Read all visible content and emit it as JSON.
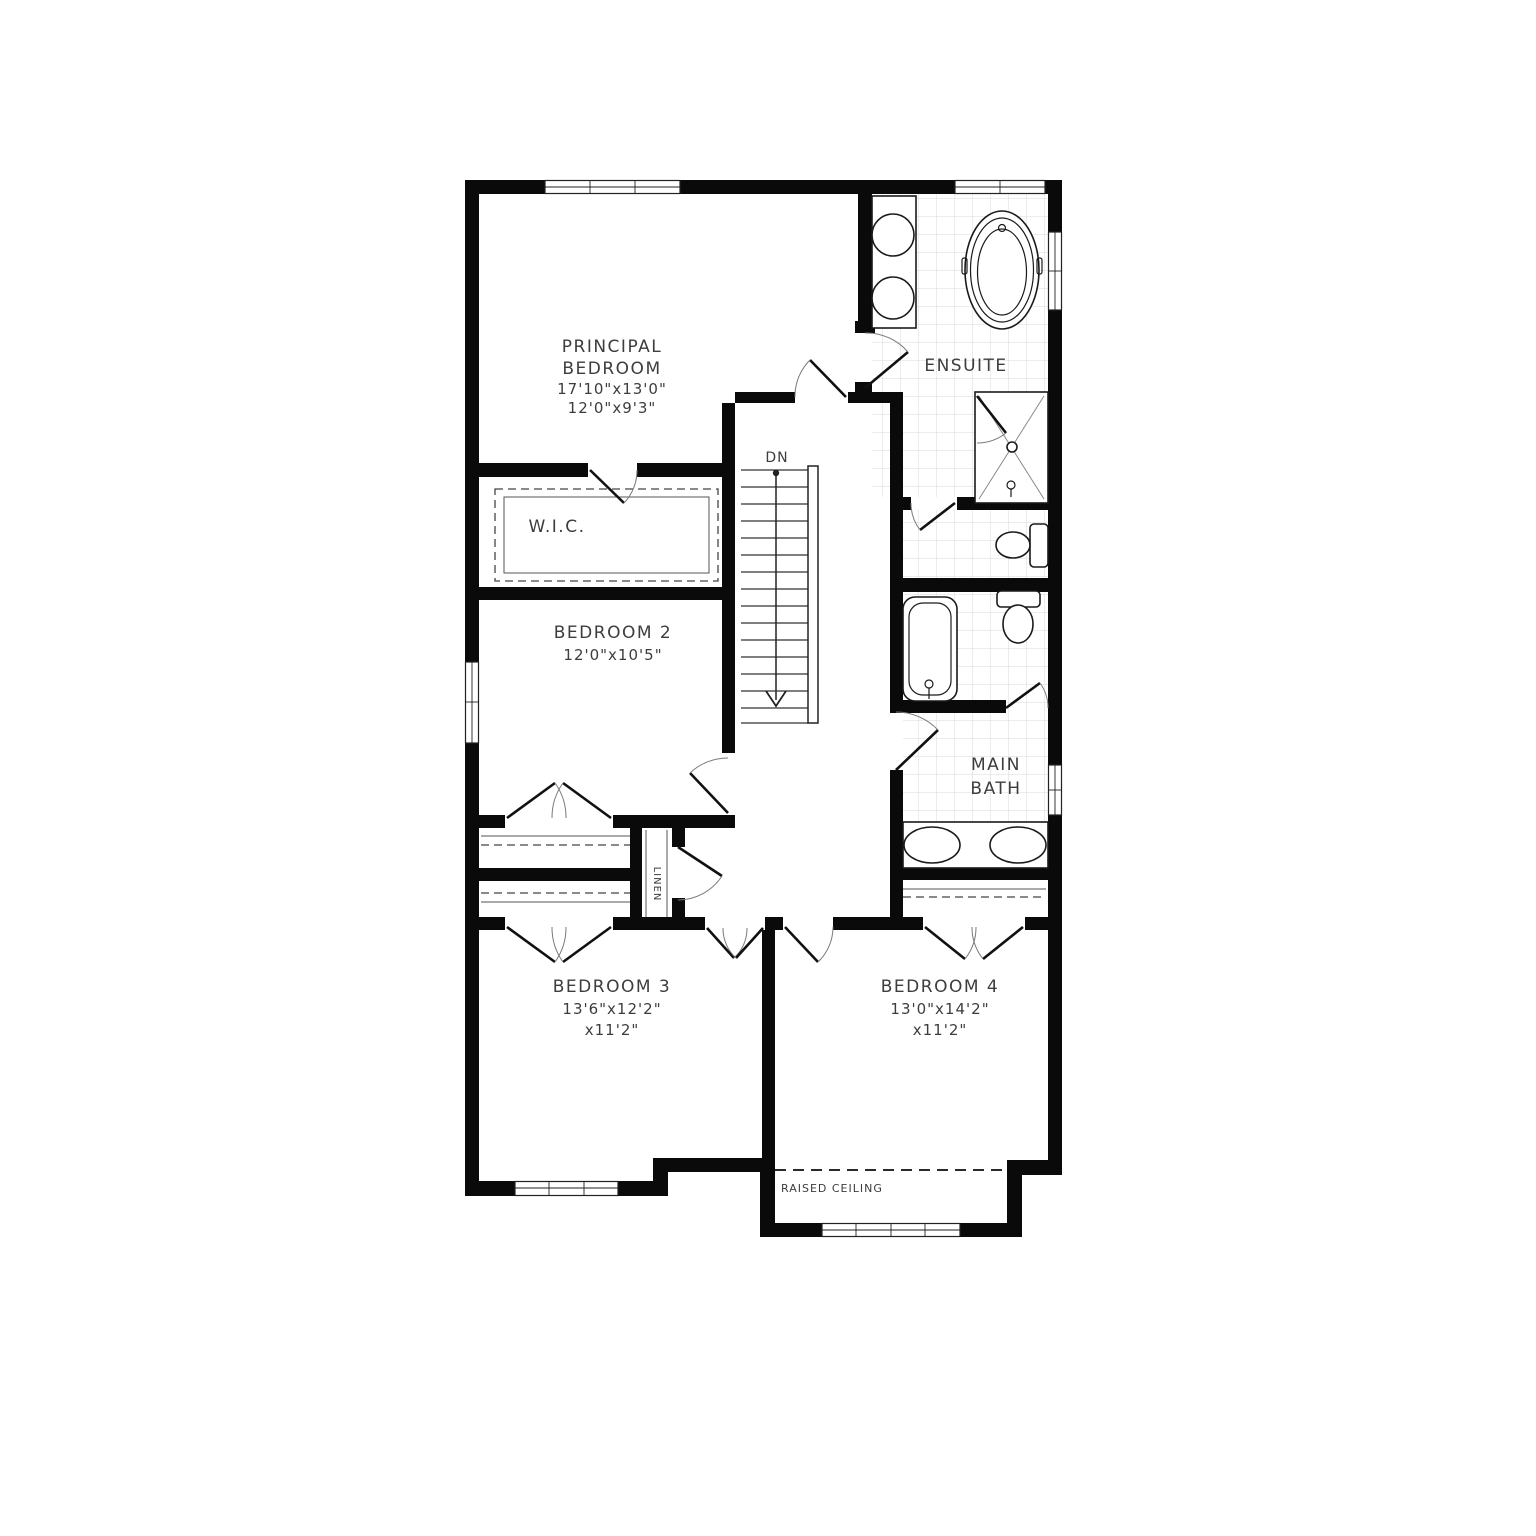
{
  "plan": {
    "rooms": {
      "principal_bedroom": {
        "name_line1": "PRINCIPAL",
        "name_line2": "BEDROOM",
        "dim_line1": "17'10\"x13'0\"",
        "dim_line2": "12'0\"x9'3\""
      },
      "ensuite": {
        "name": "ENSUITE"
      },
      "wic": {
        "name": "W.I.C."
      },
      "bedroom2": {
        "name": "BEDROOM 2",
        "dim_line1": "12'0\"x10'5\""
      },
      "main_bath": {
        "name_line1": "MAIN",
        "name_line2": "BATH"
      },
      "bedroom3": {
        "name": "BEDROOM 3",
        "dim_line1": "13'6\"x12'2\"",
        "dim_line2": "x11'2\""
      },
      "bedroom4": {
        "name": "BEDROOM 4",
        "dim_line1": "13'0\"x14'2\"",
        "dim_line2": "x11'2\""
      },
      "linen_closet": {
        "name": "LINEN"
      }
    },
    "annotations": {
      "stair_direction": "DN",
      "raised_ceiling": "RAISED CEILING"
    },
    "colors": {
      "wall": "#0a0a0a",
      "tile_grid": "#d8d8d8",
      "text": "#3d3d3d",
      "background": "#ffffff"
    }
  }
}
